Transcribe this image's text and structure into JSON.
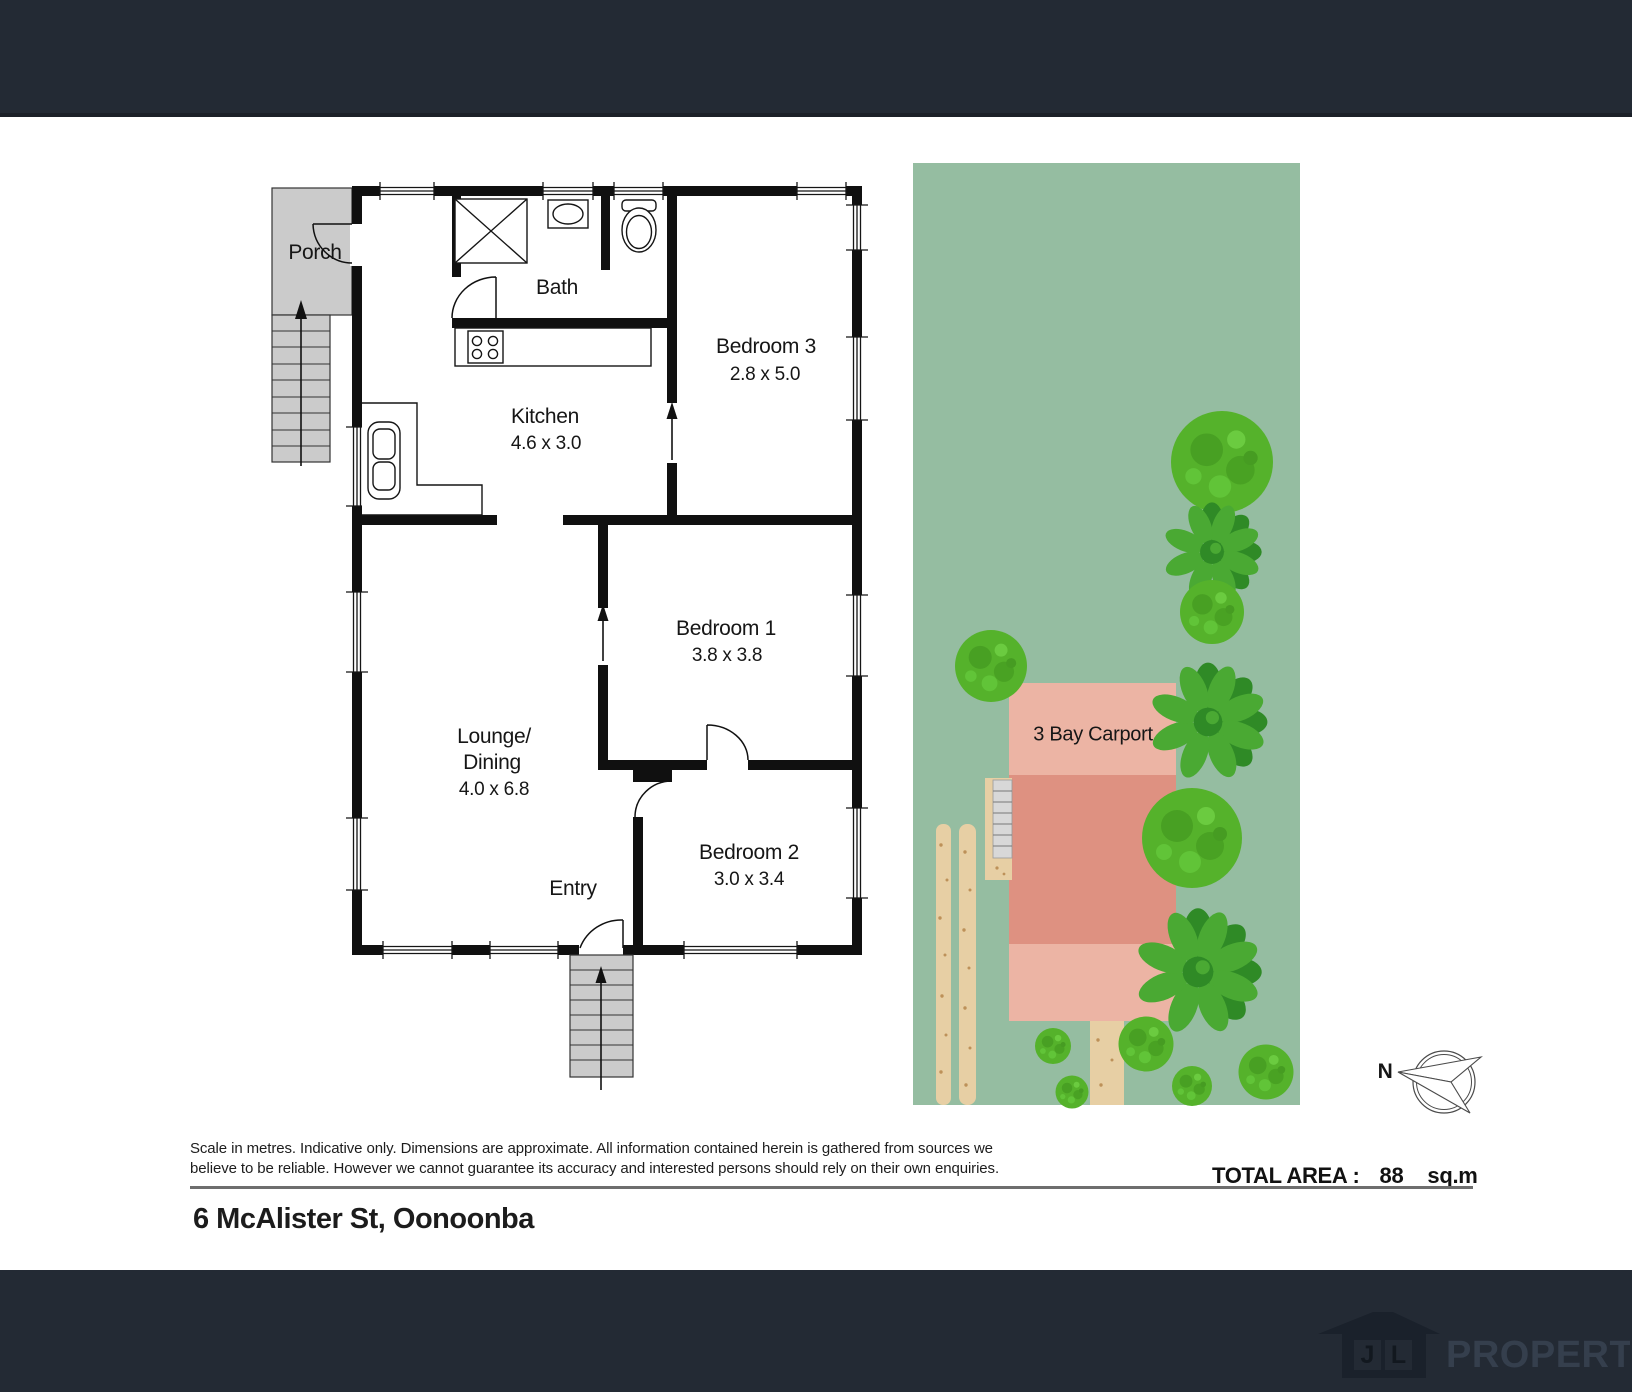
{
  "plan": {
    "rooms": {
      "porch": {
        "label": "Porch"
      },
      "bath": {
        "label": "Bath"
      },
      "kitchen": {
        "label": "Kitchen",
        "dims": "4.6 x 3.0"
      },
      "bedroom3": {
        "label": "Bedroom 3",
        "dims": "2.8 x 5.0"
      },
      "bedroom1": {
        "label": "Bedroom 1",
        "dims": "3.8 x 3.8"
      },
      "lounge": {
        "label_line1": "Lounge/",
        "label_line2": "Dining",
        "dims": "4.0 x 6.8"
      },
      "bedroom2": {
        "label": "Bedroom 2",
        "dims": "3.0 x 3.4"
      },
      "entry": {
        "label": "Entry"
      }
    },
    "site": {
      "carport_label": "3 Bay Carport"
    },
    "compass": {
      "label": "N"
    }
  },
  "summary": {
    "total_area_label": "TOTAL AREA :",
    "total_area_value": "88",
    "total_area_unit": "sq.m"
  },
  "disclaimer": {
    "line1": "Scale in metres. Indicative only. Dimensions are approximate. All information contained herein is gathered from sources we",
    "line2": "believe to be reliable. However we cannot guarantee its accuracy and interested persons should rely on their own enquiries."
  },
  "address": "6 McAlister St, Oonoonba",
  "footer": {
    "logo_j": "J",
    "logo_l": "L",
    "logo_name": "PROPERTY"
  },
  "colors": {
    "header_bg": "#232a34",
    "site_green": "#95bda1",
    "building_light": "#ecb4a4",
    "building_dark": "#de9181",
    "path_tan": "#e7cfa4",
    "stair_gray": "#cbcbcb",
    "wall_black": "#101010",
    "tree_green": "#55b22b",
    "fern_green": "#2f8a26",
    "logo_house": "#1a212b",
    "logo_text": "#353f4d"
  }
}
